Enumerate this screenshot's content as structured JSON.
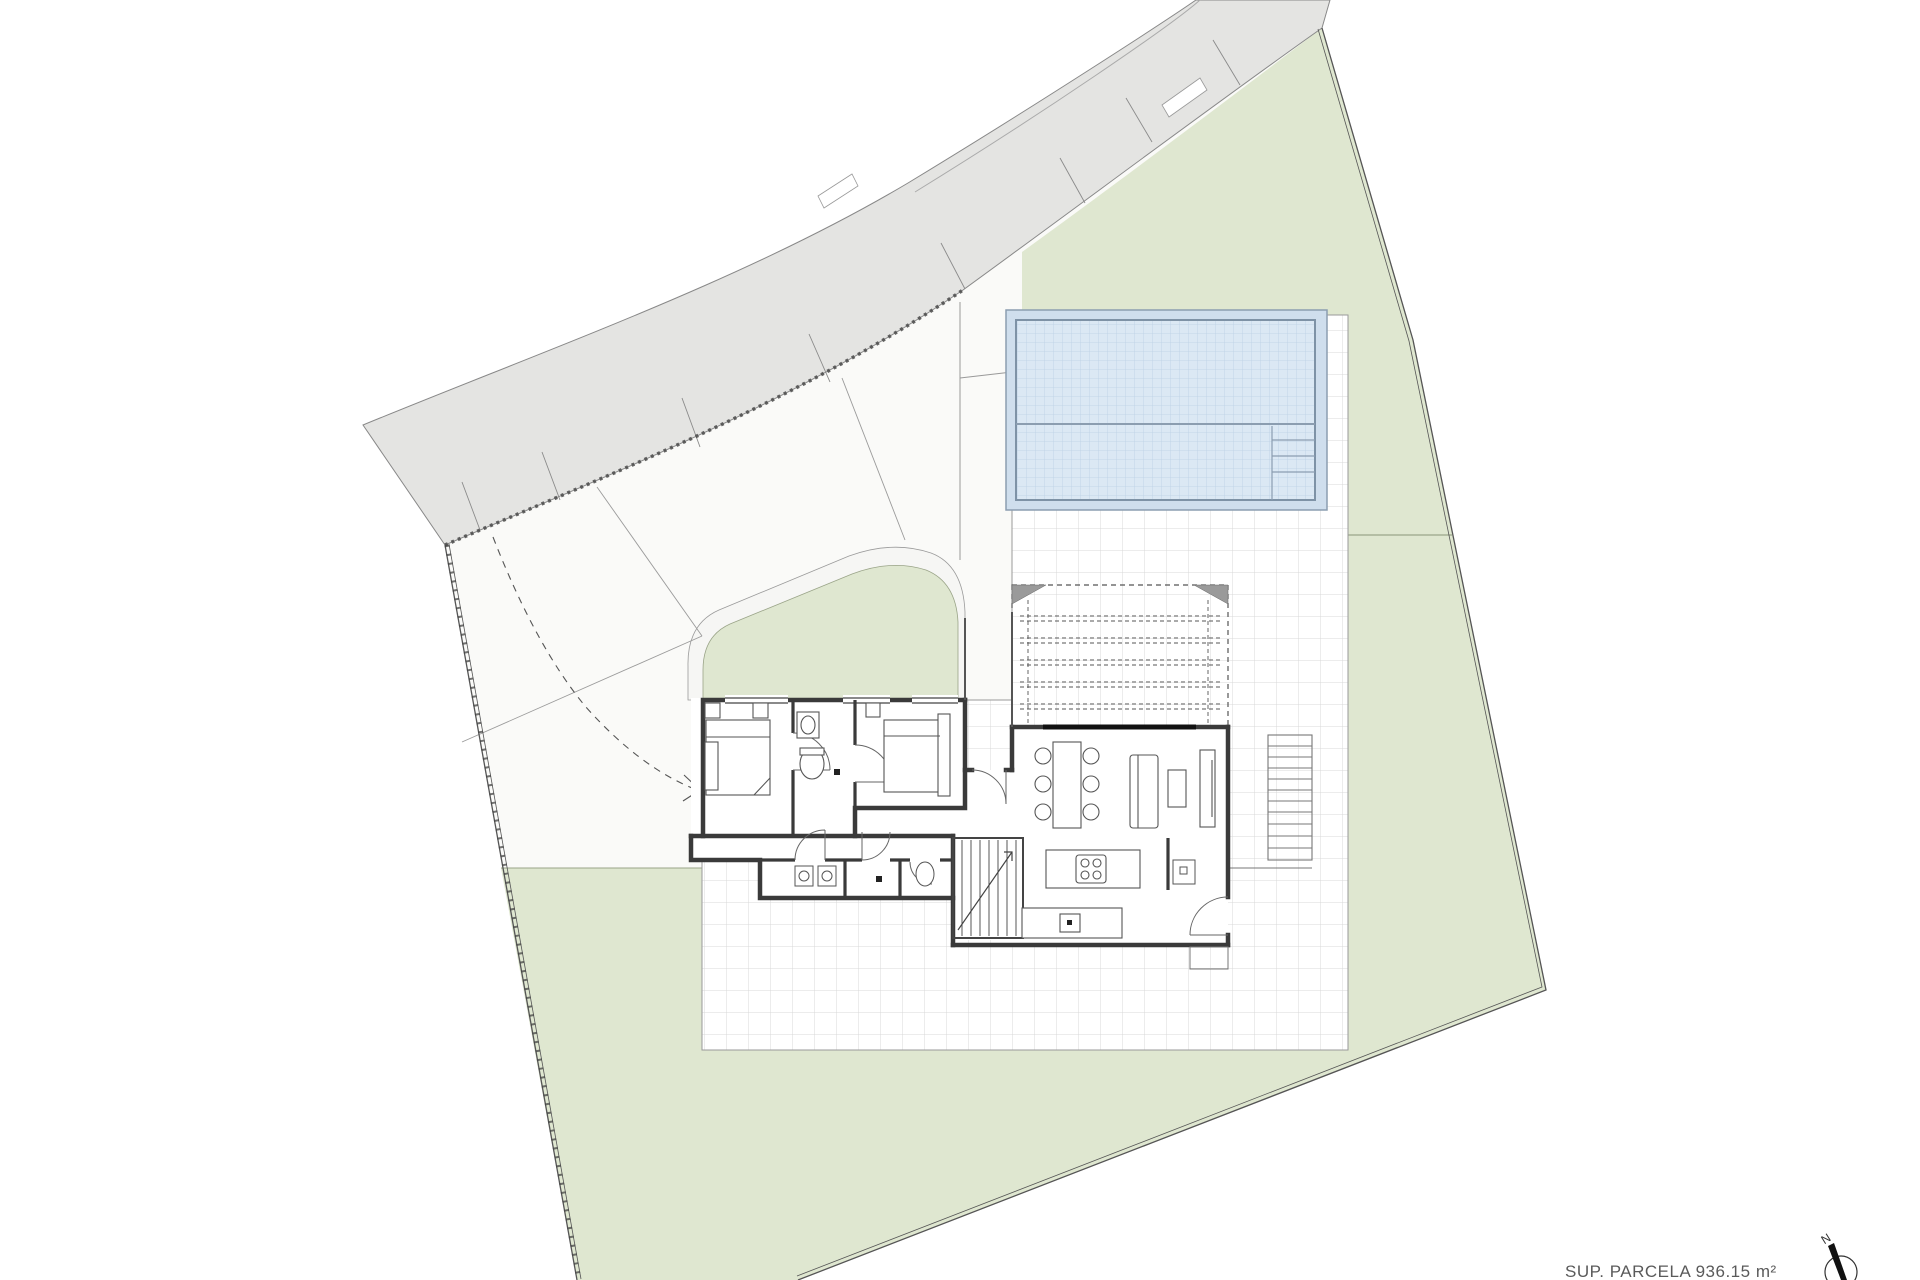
{
  "annotation": {
    "parcel_area_label": "SUP. PARCELA 936.15 m²"
  },
  "compass": {
    "north_label": "N"
  },
  "colors": {
    "garden_green": "#dfe7d0",
    "road_gray": "#e4e4e2",
    "pool_water": "#dbe8f4",
    "pool_grid": "#bcd1e4",
    "pool_border": "#8b9db0",
    "terrace_grid": "#d8d8d8",
    "wall_dark": "#3a3a3a",
    "boundary": "#555555",
    "faint_line": "#999999"
  },
  "areas": [
    {
      "name": "road-sidewalk-band",
      "fill": "#e4e4e2"
    },
    {
      "name": "driveway",
      "fill": "#ffffff"
    },
    {
      "name": "garden-right-and-bottom",
      "fill": "#dfe7d0"
    },
    {
      "name": "garden-island",
      "fill": "#dfe7d0"
    },
    {
      "name": "swimming-pool",
      "fill": "#dbe8f4"
    },
    {
      "name": "tiled-terrace",
      "fill": "#ffffff"
    },
    {
      "name": "pergola",
      "fill": "none"
    },
    {
      "name": "house",
      "fill": "#ffffff"
    }
  ]
}
